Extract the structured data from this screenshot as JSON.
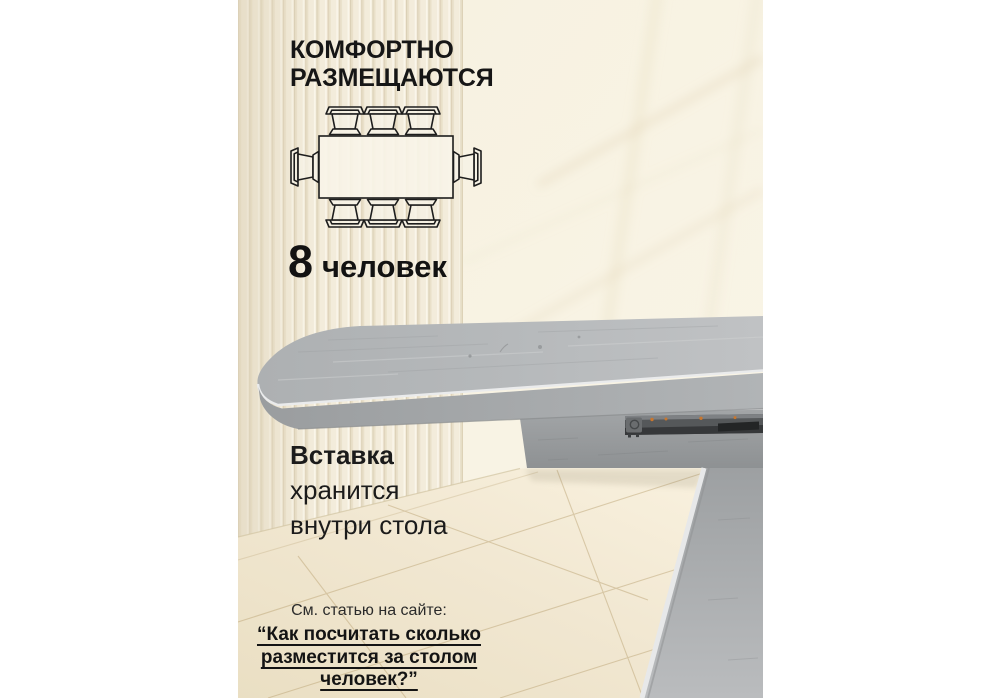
{
  "slide": {
    "language": "ru",
    "description": "Product infographic photo of an extendable concrete-look dining table in a beige room"
  },
  "capacity_section": {
    "title_line1": "КОМФОРТНО",
    "title_line2": "РАЗМЕЩАЮТСЯ",
    "number": "8",
    "label": "человек"
  },
  "seating_diagram": {
    "icon_name": "table-top-view-with-chairs-icon",
    "chairs_top": 3,
    "chairs_bottom": 3,
    "chairs_left": 1,
    "chairs_right": 1,
    "total_seats": 8
  },
  "insert_note": {
    "line1": "Вставка",
    "line2": "хранится",
    "line3": "внутри стола"
  },
  "footer": {
    "intro": "См. статью на сайте:",
    "quote_line1": "“Как посчитать сколько",
    "quote_line2": "разместится за столом",
    "quote_line3": "человек?”"
  },
  "colors": {
    "page_margin": "#ffffff",
    "slat_wall": "#f3ecdb",
    "smooth_wall": "#f7f1e1",
    "floor_tile": "#f1e7d0",
    "floor_grout": "#bda678",
    "tabletop_gray": "#b3b6b8",
    "table_edge_gray": "#a0a3a5",
    "metal_rail": "#3f4244",
    "screw_accent": "#c8772f",
    "text_dark": "#161616"
  }
}
